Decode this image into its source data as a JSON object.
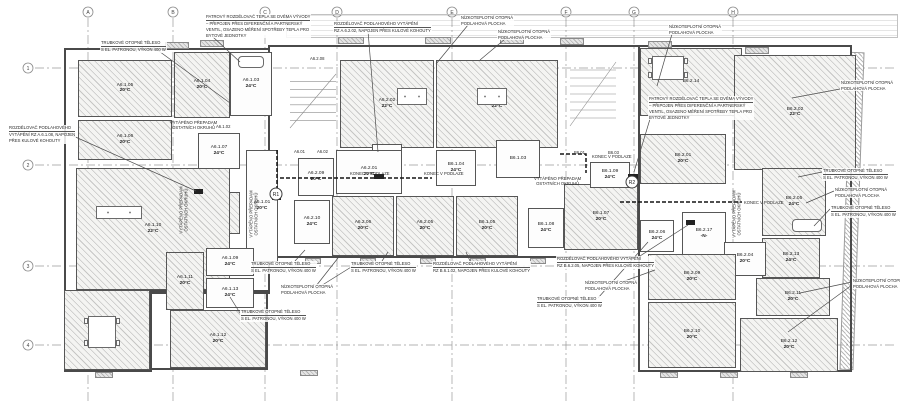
{
  "drawing": {
    "title": "Floor heating plan – level 6 (sections A6 / B6)",
    "language": "cs",
    "colors": {
      "line": "#4a4a4a",
      "grid": "#9a9a9a",
      "text": "#222222",
      "pipe": "#151515",
      "hatch_fill": "#f4f4f2"
    }
  },
  "grid": {
    "columns": [
      {
        "label": "A",
        "x": 88
      },
      {
        "label": "B",
        "x": 173
      },
      {
        "label": "C",
        "x": 265
      },
      {
        "label": "D",
        "x": 337
      },
      {
        "label": "E",
        "x": 452
      },
      {
        "label": "F",
        "x": 566
      },
      {
        "label": "G",
        "x": 634
      },
      {
        "label": "H",
        "x": 733
      }
    ],
    "rows": [
      {
        "label": "1",
        "y": 68
      },
      {
        "label": "2",
        "y": 165
      },
      {
        "label": "3",
        "y": 266
      },
      {
        "label": "4",
        "y": 345
      }
    ]
  },
  "reference_markers": [
    {
      "label": "R1",
      "x": 276,
      "y": 194
    },
    {
      "label": "R2",
      "x": 632,
      "y": 182
    }
  ],
  "rooms": [
    {
      "code": "A6.1.05",
      "temp": "20°C",
      "x": 78,
      "y": 60,
      "w": 94,
      "h": 57,
      "style": "hatch"
    },
    {
      "code": "A6.1.04",
      "temp": "20°C",
      "x": 174,
      "y": 52,
      "w": 56,
      "h": 66,
      "style": "hatch"
    },
    {
      "code": "A6.1.03",
      "temp": "24°C",
      "x": 230,
      "y": 52,
      "w": 42,
      "h": 64,
      "style": "plain"
    },
    {
      "code": "A6.1.06",
      "temp": "20°C",
      "x": 78,
      "y": 120,
      "w": 94,
      "h": 40,
      "style": "hatch"
    },
    {
      "code": "A6.1.07",
      "temp": "24°C",
      "x": 198,
      "y": 133,
      "w": 42,
      "h": 36,
      "style": "plain"
    },
    {
      "code": "A6.1.08",
      "temp": "20°C",
      "x": 192,
      "y": 192,
      "w": 48,
      "h": 42,
      "style": "hatch"
    },
    {
      "code": "A6.1.01",
      "temp": "20°C",
      "x": 246,
      "y": 150,
      "w": 32,
      "h": 112,
      "style": "plain"
    },
    {
      "code": "A6.1.10",
      "temp": "22°C",
      "x": 76,
      "y": 168,
      "w": 154,
      "h": 122,
      "style": "hatch"
    },
    {
      "code": "A6.1.14",
      "temp": "",
      "x": 64,
      "y": 290,
      "w": 86,
      "h": 80,
      "style": "hatch"
    },
    {
      "code": "A6.1.11",
      "temp": "20°C",
      "x": 166,
      "y": 252,
      "w": 38,
      "h": 58,
      "style": "hatch"
    },
    {
      "code": "A6.1.09",
      "temp": "24°C",
      "x": 206,
      "y": 248,
      "w": 48,
      "h": 28,
      "style": "plain"
    },
    {
      "code": "A6.1.13",
      "temp": "24°C",
      "x": 206,
      "y": 278,
      "w": 48,
      "h": 30,
      "style": "plain"
    },
    {
      "code": "A6.1.12",
      "temp": "20°C",
      "x": 170,
      "y": 310,
      "w": 96,
      "h": 58,
      "style": "hatch"
    },
    {
      "code": "A6.2.02",
      "temp": "22°C",
      "x": 340,
      "y": 60,
      "w": 94,
      "h": 88,
      "style": "hatch"
    },
    {
      "code": "B6.1.02",
      "temp": "22°C",
      "x": 436,
      "y": 60,
      "w": 122,
      "h": 88,
      "style": "hatch"
    },
    {
      "code": "A6.2.11",
      "temp": "",
      "x": 372,
      "y": 144,
      "w": 30,
      "h": 20,
      "style": "plain"
    },
    {
      "code": "A6.2.09",
      "temp": "20°C",
      "x": 298,
      "y": 158,
      "w": 36,
      "h": 38,
      "style": "plain"
    },
    {
      "code": "A6.2.01",
      "temp": "20°C",
      "x": 336,
      "y": 150,
      "w": 66,
      "h": 44,
      "style": "plain"
    },
    {
      "code": "A6.2.10",
      "temp": "24°C",
      "x": 294,
      "y": 200,
      "w": 36,
      "h": 44,
      "style": "plain"
    },
    {
      "code": "A6.2.06",
      "temp": "20°C",
      "x": 332,
      "y": 196,
      "w": 62,
      "h": 60,
      "style": "hatch"
    },
    {
      "code": "A6.2.05",
      "temp": "20°C",
      "x": 396,
      "y": 196,
      "w": 58,
      "h": 60,
      "style": "hatch"
    },
    {
      "code": "B6.1.05",
      "temp": "20°C",
      "x": 456,
      "y": 196,
      "w": 62,
      "h": 60,
      "style": "hatch"
    },
    {
      "code": "B6.1.04",
      "temp": "24°C",
      "x": 436,
      "y": 150,
      "w": 40,
      "h": 36,
      "style": "plain"
    },
    {
      "code": "B6.1.03",
      "temp": "",
      "x": 496,
      "y": 140,
      "w": 44,
      "h": 38,
      "style": "plain"
    },
    {
      "code": "B6.1.08",
      "temp": "24°C",
      "x": 528,
      "y": 208,
      "w": 36,
      "h": 40,
      "style": "plain"
    },
    {
      "code": "B6.1.07",
      "temp": "20°C",
      "x": 564,
      "y": 184,
      "w": 74,
      "h": 66,
      "style": "hatch"
    },
    {
      "code": "B6.1.09",
      "temp": "24°C",
      "x": 590,
      "y": 162,
      "w": 40,
      "h": 26,
      "style": "plain"
    },
    {
      "code": "B6.2.01",
      "temp": "20°C",
      "x": 640,
      "y": 134,
      "w": 86,
      "h": 50,
      "style": "hatch"
    },
    {
      "code": "B6.2.14",
      "temp": "",
      "x": 640,
      "y": 48,
      "w": 102,
      "h": 68,
      "style": "hatch"
    },
    {
      "code": "B6.2.02",
      "temp": "22°C",
      "x": 734,
      "y": 55,
      "w": 122,
      "h": 115,
      "style": "hatch"
    },
    {
      "code": "B6.2.06",
      "temp": "24°C",
      "x": 640,
      "y": 220,
      "w": 34,
      "h": 32,
      "style": "plain"
    },
    {
      "code": "B6.2.17",
      "temp": "-N-",
      "x": 682,
      "y": 212,
      "w": 44,
      "h": 44,
      "style": "plain"
    },
    {
      "code": "B6.2.05",
      "temp": "24°C",
      "x": 762,
      "y": 168,
      "w": 64,
      "h": 68,
      "style": "hatch"
    },
    {
      "code": "B6.2.13",
      "temp": "24°C",
      "x": 762,
      "y": 238,
      "w": 58,
      "h": 40,
      "style": "hatch"
    },
    {
      "code": "B6.2.11",
      "temp": "20°C",
      "x": 756,
      "y": 278,
      "w": 74,
      "h": 38,
      "style": "hatch"
    },
    {
      "code": "B6.2.04",
      "temp": "20°C",
      "x": 724,
      "y": 242,
      "w": 42,
      "h": 34,
      "style": "plain"
    },
    {
      "code": "B6.2.09",
      "temp": "20°C",
      "x": 648,
      "y": 254,
      "w": 88,
      "h": 46,
      "style": "hatch"
    },
    {
      "code": "B6.2.10",
      "temp": "20°C",
      "x": 648,
      "y": 302,
      "w": 88,
      "h": 66,
      "style": "hatch"
    },
    {
      "code": "B6.2.12",
      "temp": "20°C",
      "x": 740,
      "y": 318,
      "w": 98,
      "h": 54,
      "style": "hatch"
    }
  ],
  "room_notes": [
    {
      "lines": [
        "VYTÁPĚNO PŘEPADAM",
        "OSTATNÍCH OKRUHŮ"
      ],
      "x": 170,
      "y": 120,
      "vertical": false
    },
    {
      "lines": [
        "VYTÁPĚNO PŘEPADAM",
        "OSTATNÍCH OKRUHŮ"
      ],
      "x": 534,
      "y": 176,
      "vertical": false
    },
    {
      "lines": [
        "VYTÁPĚNO PŘEPADAM",
        "OSTATNÍCH OKRUHŮ"
      ],
      "x": 254,
      "y": 214,
      "vertical": true
    },
    {
      "lines": [
        "VYTÁPĚNO PŘEPADAM",
        "OSTATNÍCH OKRUHŮ"
      ],
      "x": 737,
      "y": 214,
      "vertical": true
    },
    {
      "lines": [
        "VYTÁPĚNO PŘEPADAM",
        "OSTATNÍCH OKRUHŮ"
      ],
      "x": 184,
      "y": 210,
      "vertical": true
    }
  ],
  "tiny_labels": [
    {
      "text": "A6.1.02",
      "x": 216,
      "y": 124
    },
    {
      "text": "A6.01",
      "x": 294,
      "y": 149
    },
    {
      "text": "A6.02",
      "x": 317,
      "y": 149
    },
    {
      "text": "B6.01",
      "x": 574,
      "y": 150
    },
    {
      "text": "B6.03",
      "x": 608,
      "y": 150
    },
    {
      "text": "A6.2.08",
      "x": 310,
      "y": 56
    },
    {
      "text": "KONEC V PODLAZE",
      "x": 350,
      "y": 171
    },
    {
      "text": "KONEC V PODLAZE",
      "x": 424,
      "y": 171
    },
    {
      "text": "KONEC V PODLAZE",
      "x": 592,
      "y": 154
    },
    {
      "text": "KONEC V PODLAZE",
      "x": 744,
      "y": 200
    }
  ],
  "annotations": [
    {
      "x": 100,
      "y": 40,
      "underline": true,
      "lines": [
        "TRUBKOVÉ OTOPNÉ TĚLESO",
        "S EL. PATRONOU, VÝKON 400 W"
      ],
      "leaders": [
        [
          152,
          46,
          230,
          103
        ]
      ]
    },
    {
      "x": 205,
      "y": 14,
      "underline": true,
      "lines": [
        "PATROVÝ ROZDĚLOVAČ TEPLA SE DVĚMA VÝVODY",
        "– PŘIPOJEN PŘES DIFERENČNÍ A PARTNERSKÝ",
        "VENTIL, OSAZENO MĚŘENÍ SPOTŘEBY TEPLA PRO",
        "BYTOVÉ JEDNOTKY"
      ],
      "leaders": [
        [
          213,
          37,
          240,
          62
        ]
      ]
    },
    {
      "x": 333,
      "y": 21,
      "underline": true,
      "lines": [
        "ROZDĚLOVAČ PODLAHOVÉHO VYTÁPĚNÍ",
        "RZ A.6.2.02, NAPOJEN PŘES KULOVÉ KOHOUTY"
      ],
      "leaders": [
        [
          368,
          31,
          378,
          152
        ]
      ]
    },
    {
      "x": 460,
      "y": 15,
      "underline": false,
      "lines": [
        "NÍZKOTEPLOTNÍ OTOPNÁ",
        "PODLAHOVÁ PLOCHA"
      ],
      "leaders": [
        [
          468,
          25,
          436,
          64
        ]
      ]
    },
    {
      "x": 497,
      "y": 29,
      "underline": false,
      "lines": [
        "NÍZKOTEPLOTNÍ OTOPNÁ",
        "PODLAHOVÁ PLOCHA"
      ],
      "leaders": [
        [
          505,
          39,
          480,
          60
        ]
      ]
    },
    {
      "x": 668,
      "y": 24,
      "underline": false,
      "lines": [
        "NÍZKOTEPLOTNÍ OTOPNÁ",
        "PODLAHOVÁ PLOCHA"
      ],
      "leaders": [
        [
          672,
          34,
          657,
          86
        ]
      ]
    },
    {
      "x": 840,
      "y": 80,
      "underline": false,
      "lines": [
        "NÍZKOTEPLOTNÍ OTOPNÁ",
        "PODLAHOVÁ PLOCHA"
      ],
      "leaders": [
        [
          840,
          89,
          792,
          98
        ]
      ]
    },
    {
      "x": 648,
      "y": 96,
      "underline": true,
      "lines": [
        "PATROVÝ ROZDĚLOVAČ TEPLA SE DVĚMA VÝVODY",
        "– PŘIPOJEN PŘES DIFERENČNÍ A PARTNERSKÝ",
        "VENTIL, OSAZENO MĚŘENÍ SPOTŘEBY TEPLA PRO",
        "BYTOVÉ JEDNOTKY"
      ],
      "leaders": [
        [
          650,
          119,
          634,
          172
        ]
      ]
    },
    {
      "x": 8,
      "y": 125,
      "underline": true,
      "lines": [
        "ROZDĚLOVAČ PODLAHOVÉHO",
        "VYTÁPĚNÍ RZ A.6.1.08, NAPOJEN",
        "PŘES KULOVÉ KOHOUTY"
      ],
      "leaders": [
        [
          62,
          131,
          196,
          191
        ]
      ]
    },
    {
      "x": 250,
      "y": 261,
      "underline": true,
      "lines": [
        "TRUBKOVÉ OTOPNÉ TĚLESO",
        "S EL. PATRONOU, VÝKON 400 W"
      ],
      "leaders": [
        [
          295,
          261,
          305,
          250
        ]
      ]
    },
    {
      "x": 350,
      "y": 261,
      "underline": true,
      "lines": [
        "TRUBKOVÉ OTOPNÉ TĚLESO",
        "S EL. PATRONOU, VÝKON 400 W"
      ],
      "leaders": [
        [
          382,
          261,
          388,
          252
        ]
      ]
    },
    {
      "x": 432,
      "y": 261,
      "underline": true,
      "lines": [
        "ROZDĚLOVAČ PODLAHOVÉHO VYTÁPĚNÍ",
        "RZ B.6.1.02, NAPOJEN PŘES KULOVÉ KOHOUTY"
      ],
      "leaders": [
        [
          470,
          261,
          466,
          252
        ]
      ]
    },
    {
      "x": 280,
      "y": 284,
      "underline": false,
      "lines": [
        "NÍZKOTEPLOTNÍ OTOPNÁ",
        "PODLAHOVÁ PLOCHA"
      ],
      "leaders": [
        [
          316,
          286,
          338,
          258
        ],
        [
          316,
          289,
          356,
          264
        ]
      ]
    },
    {
      "x": 240,
      "y": 309,
      "underline": true,
      "lines": [
        "TRUBKOVÉ OTOPNÉ TĚLESO",
        "S EL. PATRONOU, VÝKON 400 W"
      ],
      "leaders": [
        [
          240,
          313,
          230,
          297
        ]
      ]
    },
    {
      "x": 556,
      "y": 256,
      "underline": true,
      "lines": [
        "ROZDĚLOVAČ PODLAHOVÉHO VYTÁPĚNÍ",
        "RZ B.6.2.05, NAPOJEN PŘES KULOVÉ KOHOUTY"
      ],
      "leaders": [
        [
          640,
          256,
          688,
          225
        ]
      ]
    },
    {
      "x": 584,
      "y": 280,
      "underline": false,
      "lines": [
        "NÍZKOTEPLOTNÍ OTOPNÁ",
        "PODLAHOVÁ PLOCHA"
      ],
      "leaders": [
        [
          622,
          282,
          655,
          270
        ]
      ]
    },
    {
      "x": 536,
      "y": 296,
      "underline": true,
      "lines": [
        "TRUBKOVÉ OTOPNÉ TĚLESO",
        "S EL. PATRONOU, VÝKON 400 W"
      ],
      "leaders": [
        [
          598,
          298,
          648,
          242
        ]
      ]
    },
    {
      "x": 822,
      "y": 168,
      "underline": true,
      "lines": [
        "TRUBKOVÉ OTOPNÉ TĚLESO",
        "S EL. PATRONOU, VÝKON 400 W"
      ],
      "leaders": [
        [
          822,
          172,
          798,
          177
        ]
      ]
    },
    {
      "x": 834,
      "y": 187,
      "underline": false,
      "lines": [
        "NÍZKOTEPLOTNÍ OTOPNÁ",
        "PODLAHOVÁ PLOCHA"
      ],
      "leaders": [
        [
          834,
          191,
          806,
          203
        ]
      ]
    },
    {
      "x": 830,
      "y": 205,
      "underline": true,
      "lines": [
        "TRUBKOVÉ OTOPNÉ TĚLESO",
        "S EL. PATRONOU, VÝKON 400 W"
      ],
      "leaders": [
        [
          830,
          209,
          814,
          226
        ]
      ]
    },
    {
      "x": 852,
      "y": 278,
      "underline": false,
      "lines": [
        "NÍZKOTEPLOTNÍ OTOPNÁ",
        "PODLAHOVÁ PLOCHA"
      ],
      "leaders": [
        [
          852,
          282,
          800,
          293
        ],
        [
          852,
          285,
          788,
          332
        ]
      ]
    }
  ]
}
